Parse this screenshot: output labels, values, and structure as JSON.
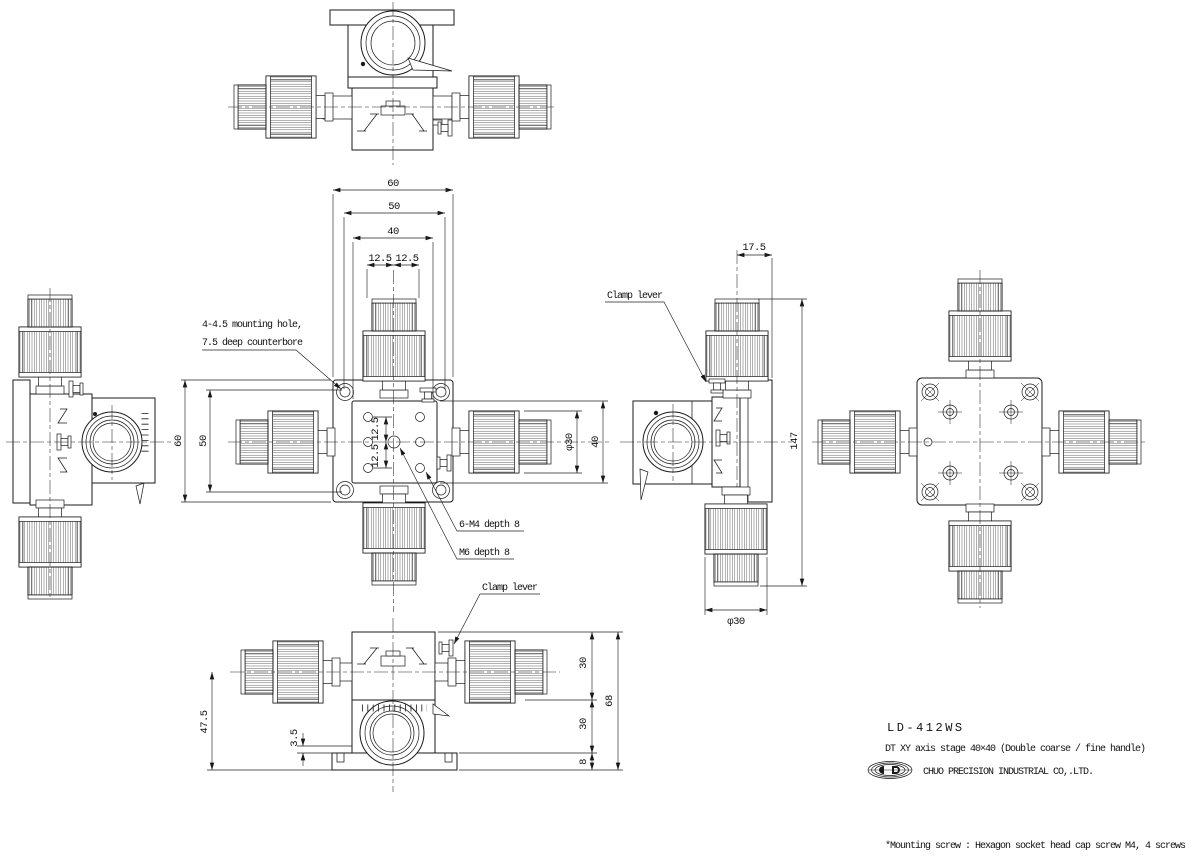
{
  "title_block": {
    "model": "LD-412WS",
    "description": "DT XY axis stage 40×40  (Double coarse / fine handle)",
    "company": "CHUO PRECISION INDUSTRIAL CO,.LTD."
  },
  "footnote": "*Mounting screw : Hexagon socket head cap screw M4, 4 screws",
  "labels": {
    "mounting_hole_1": "4-4.5 mounting hole,",
    "mounting_hole_2": "7.5 deep counterbore",
    "clamp_lever_right": "Clamp lever",
    "clamp_lever_bottom": "Clamp lever",
    "m4_holes": "6-M4 depth 8",
    "m6_hole": "M6 depth 8"
  },
  "dimensions": {
    "plan_width_outer": "60",
    "plan_width_holes": "50",
    "plan_width_stage": "40",
    "plan_pitch_left": "12.5",
    "plan_pitch_right": "12.5",
    "plan_height_outer": "60",
    "plan_height_holes": "50",
    "plan_pitch_upper": "12.5",
    "plan_pitch_lower": "12.5",
    "plan_knob_dia": "φ30",
    "plan_stage_height": "40",
    "side_knob_offset": "17.5",
    "side_total_height": "147",
    "side_knob_dia": "φ30",
    "front_handle_height": "47.5",
    "front_base_step": "3.5",
    "front_upper_body": "30",
    "front_total_height": "68",
    "front_lower_body": "30",
    "front_base_height": "8"
  }
}
